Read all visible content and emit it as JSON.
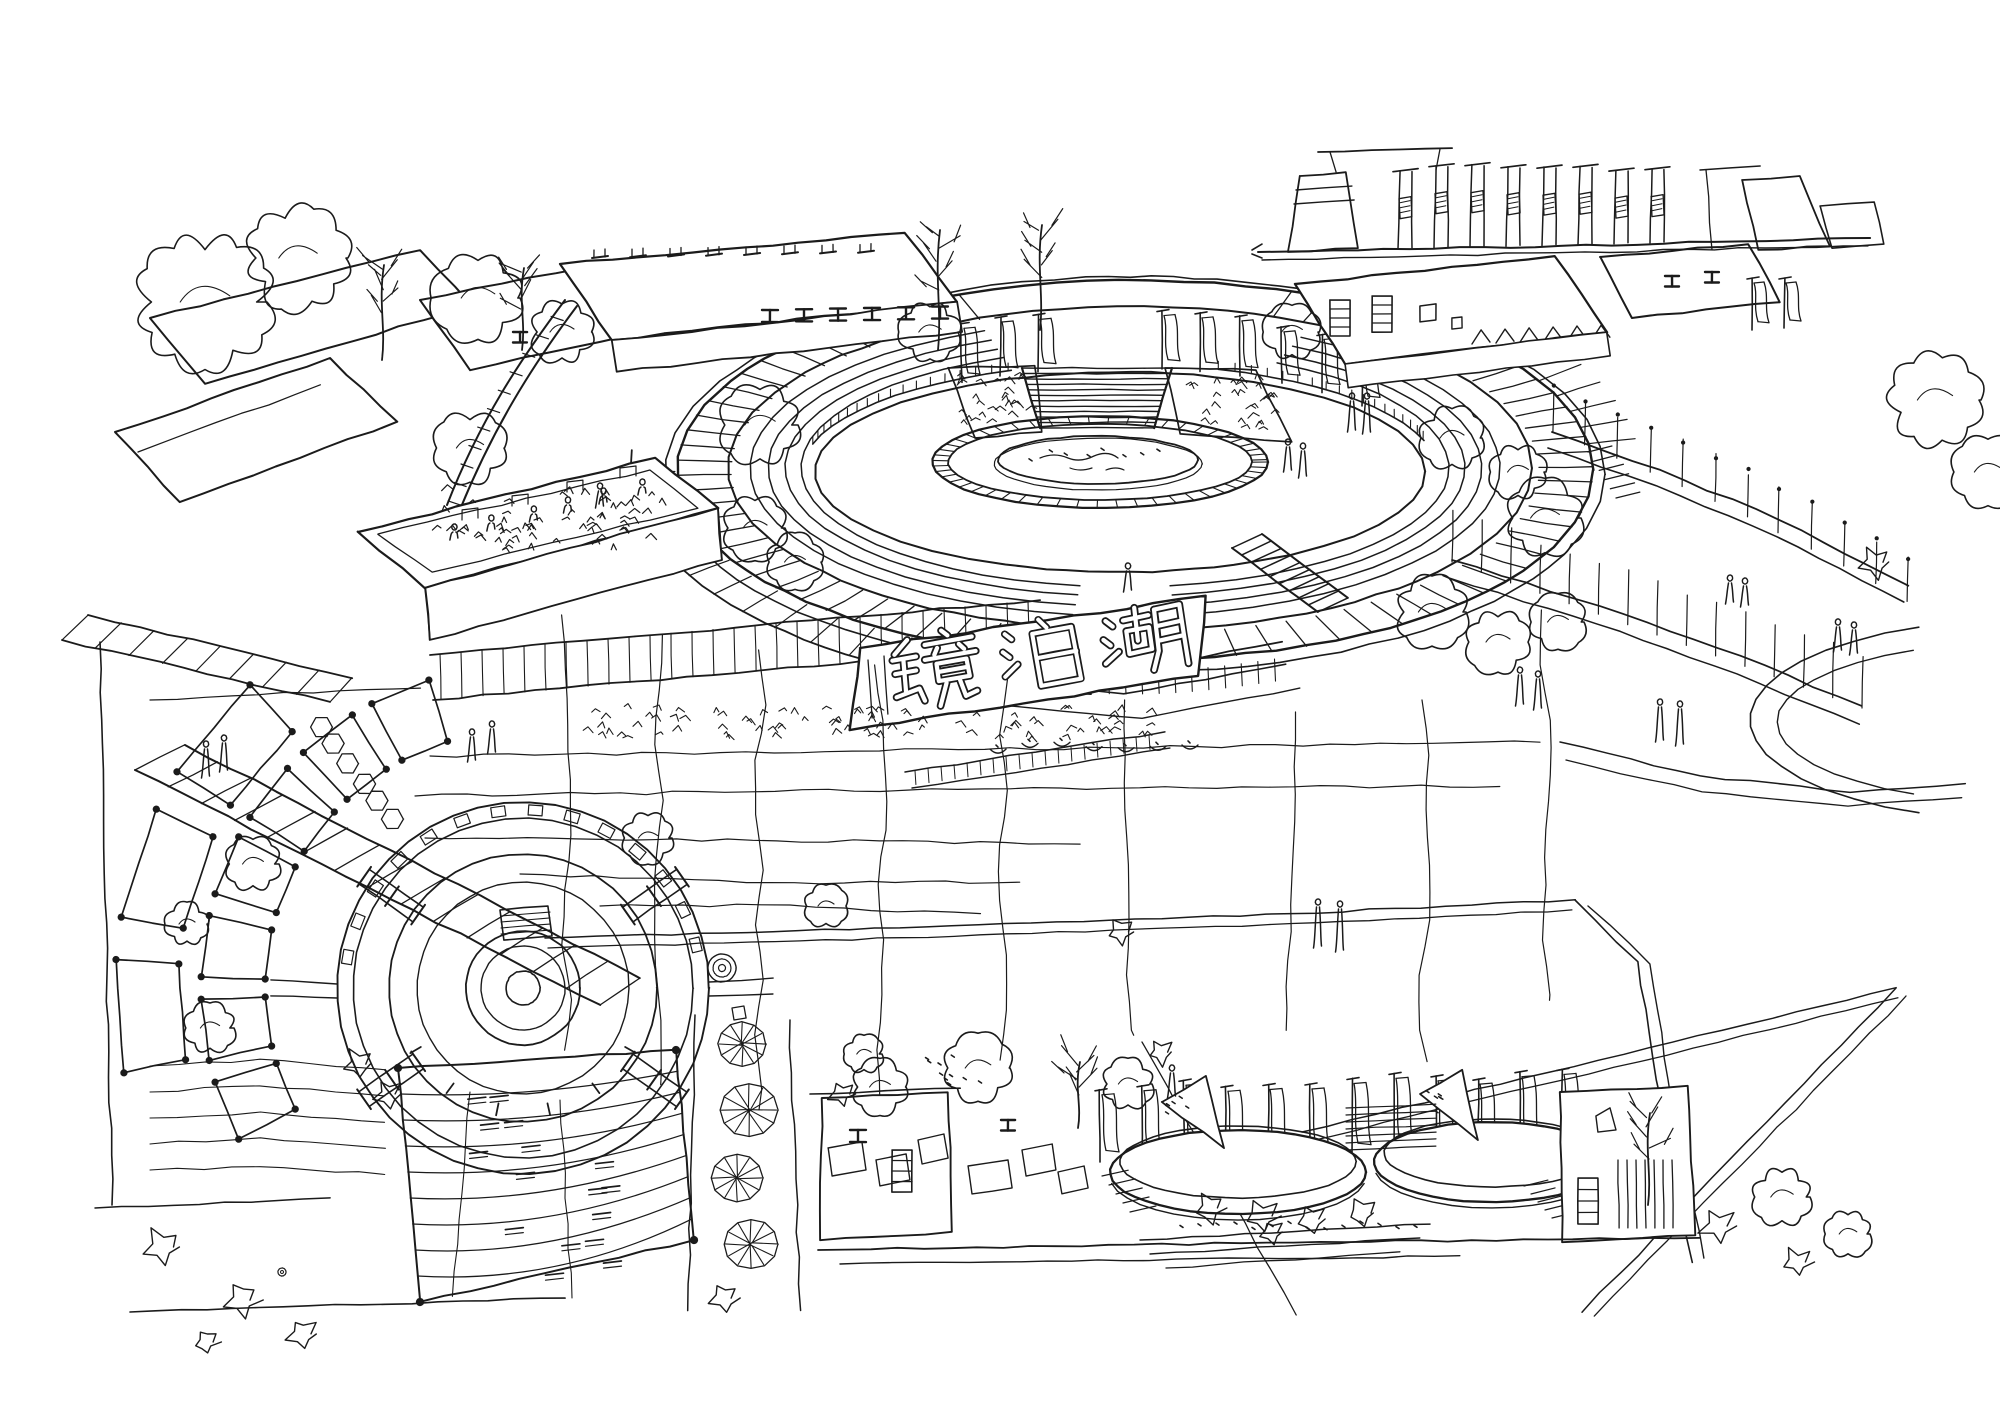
{
  "artwork": {
    "kind": "architectural concept sketch",
    "medium": "freehand pen-and-ink line drawing, black ink on white paper",
    "view": "aerial perspective with plan-view plaza and two elevation vignettes",
    "subject": "Jingpo Lake waterfront plaza and amphitheater landscape design sketch"
  },
  "sign": {
    "text": "镜泊湖",
    "romanized": "Jingpo Hu",
    "translation": "Jingpo Lake"
  },
  "palette": {
    "paper": "#ffffff",
    "ink": "#1b1b1b"
  },
  "regions": [
    {
      "name": "gate-elevation-vignette",
      "description": "elevation study of an entry gateway with paired posts and hanging banners, top right"
    },
    {
      "name": "oval-plaza",
      "description": "large sunken elliptical plaza with radial paving band, concentric steps, grand stair, banner row and central island pool"
    },
    {
      "name": "terraced-buildings-left",
      "description": "stepped pavilion roofs with roof-garden planters, pergolas and large trees"
    },
    {
      "name": "jingpo-lake-sign",
      "description": "sloped planting bed carrying the outlined characters 镜泊湖 above lotus pond and terraces"
    },
    {
      "name": "circular-plaza-plan",
      "description": "plan-view circular plaza with concentric rings, radial trellis arms, curved pergola arc and terraced lawn"
    },
    {
      "name": "twin-pools-vignette",
      "description": "elevation vignette of two shallow round pools with sail sculptures and a row of flag banners, bottom center"
    },
    {
      "name": "right-terraces",
      "description": "curved terraces with bollard rows, looping garden paths and strolling figures"
    }
  ]
}
